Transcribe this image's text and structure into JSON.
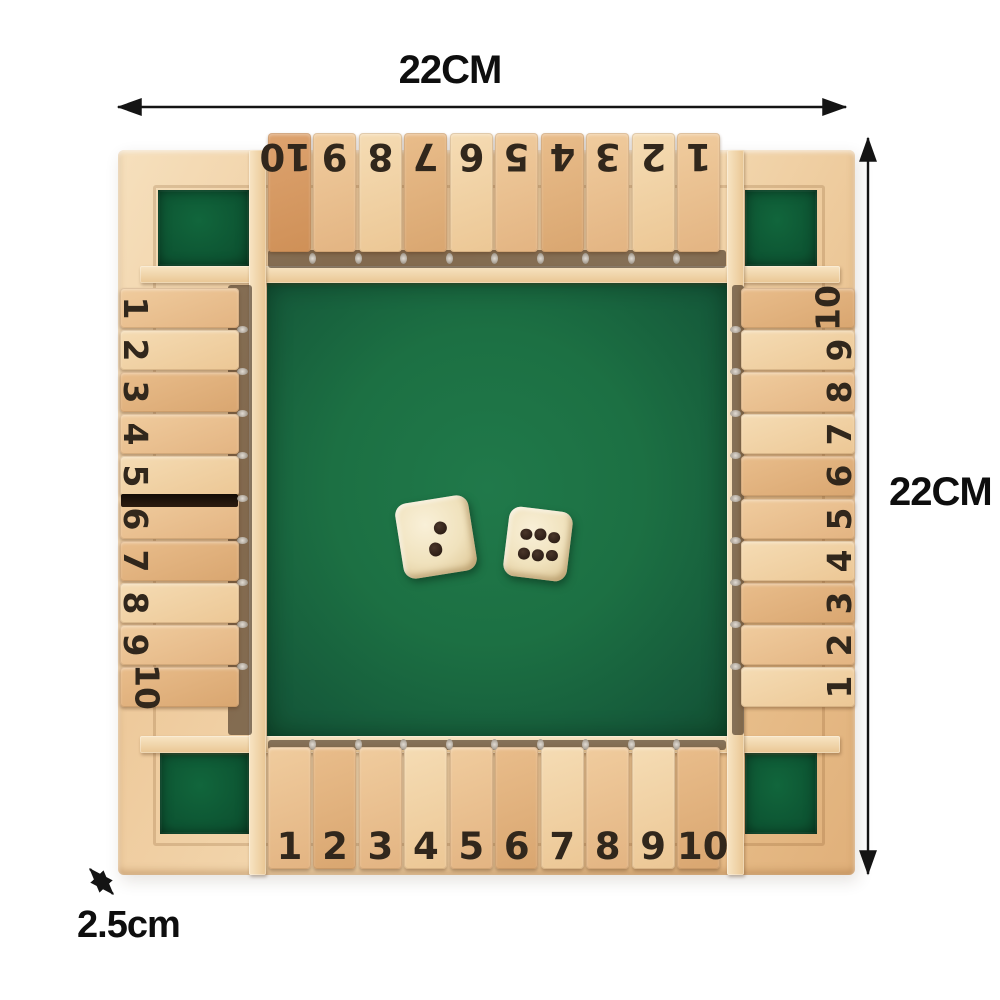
{
  "annotations": {
    "width_label": "22CM",
    "height_label": "22CM",
    "thickness_label": "2.5cm"
  },
  "board": {
    "top_tiles": [
      "10",
      "9",
      "8",
      "7",
      "6",
      "5",
      "4",
      "3",
      "2",
      "1"
    ],
    "left_tiles": [
      "1",
      "2",
      "3",
      "4",
      "5",
      "6",
      "7",
      "8",
      "9",
      "10"
    ],
    "right_tiles": [
      "10",
      "9",
      "8",
      "7",
      "6",
      "5",
      "4",
      "3",
      "2",
      "1"
    ],
    "bottom_tiles": [
      "1",
      "2",
      "3",
      "4",
      "5",
      "6",
      "7",
      "8",
      "9",
      "10"
    ]
  },
  "dice": [
    {
      "id": "die-left",
      "value": 2
    },
    {
      "id": "die-right",
      "value": 6
    }
  ],
  "colors": {
    "background": "#ffffff",
    "felt_green": "#1c7043",
    "pocket_green": "#0d5432",
    "wood_frame": "#eeca9c",
    "wood_tile": "#f0cc9e",
    "dice_cream": "#f0e2bd",
    "pip_brown": "#22150e",
    "annotation_black": "#0e0e0e"
  }
}
